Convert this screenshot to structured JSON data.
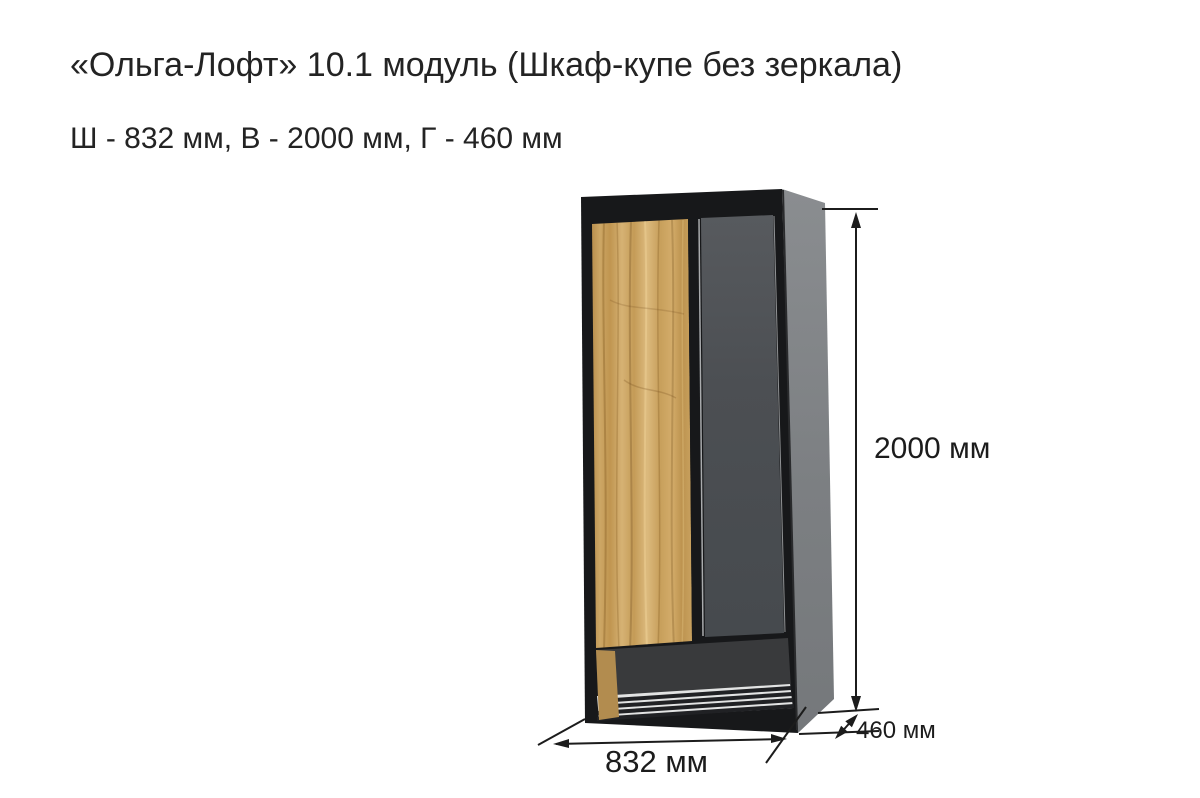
{
  "header": {
    "title": "«Ольга-Лофт» 10.1 модуль (Шкаф-купе без зеркала)",
    "subtitle": "Ш - 832 мм, В - 2000 мм, Г - 460 мм"
  },
  "figure": {
    "height_label": "2000 мм",
    "width_label": "832 мм",
    "depth_label": "460 мм",
    "colors": {
      "background": "#ffffff",
      "frame": "#17181a",
      "side_panel": "#7e8184",
      "left_door_oak": "#c9a25e",
      "right_door": "#4b4e52",
      "niche_back": "#393a3c",
      "niche_wood": "#b28c4f",
      "niche_floor": "#e2e3e3",
      "rail": "#202124",
      "dimension": "#1c1c1c",
      "text": "#232323"
    }
  }
}
